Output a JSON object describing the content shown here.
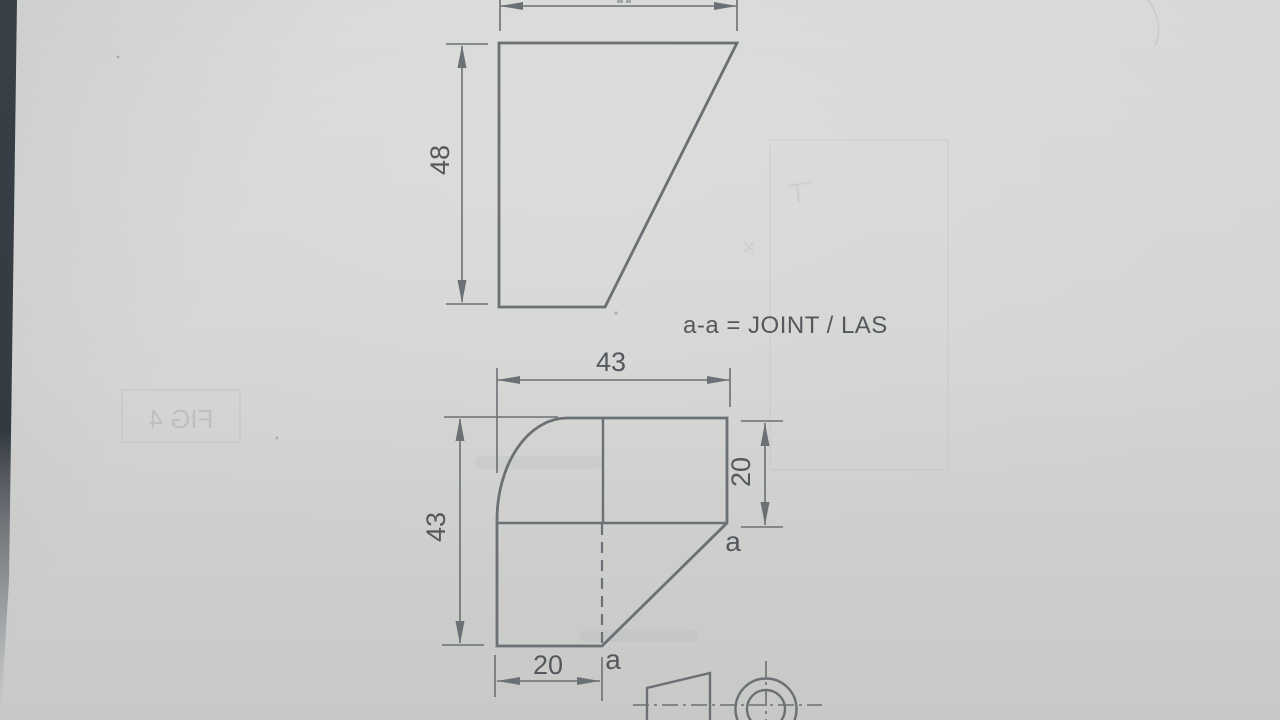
{
  "colors": {
    "paper": "#d3d4d2",
    "line": "#6b7074",
    "ink": "#54585d",
    "edge_strip": "#394047"
  },
  "views": {
    "front": {
      "height_dim": "48"
    },
    "lower": {
      "width_dim": "43",
      "height_dim": "43",
      "side_dim": "20",
      "bottom_dim": "20",
      "section_point_upper": "a",
      "section_point_lower": "a"
    }
  },
  "annotations": {
    "note": "a-a = JOINT / LAS",
    "ghost_figure_label": "FIG 4"
  }
}
